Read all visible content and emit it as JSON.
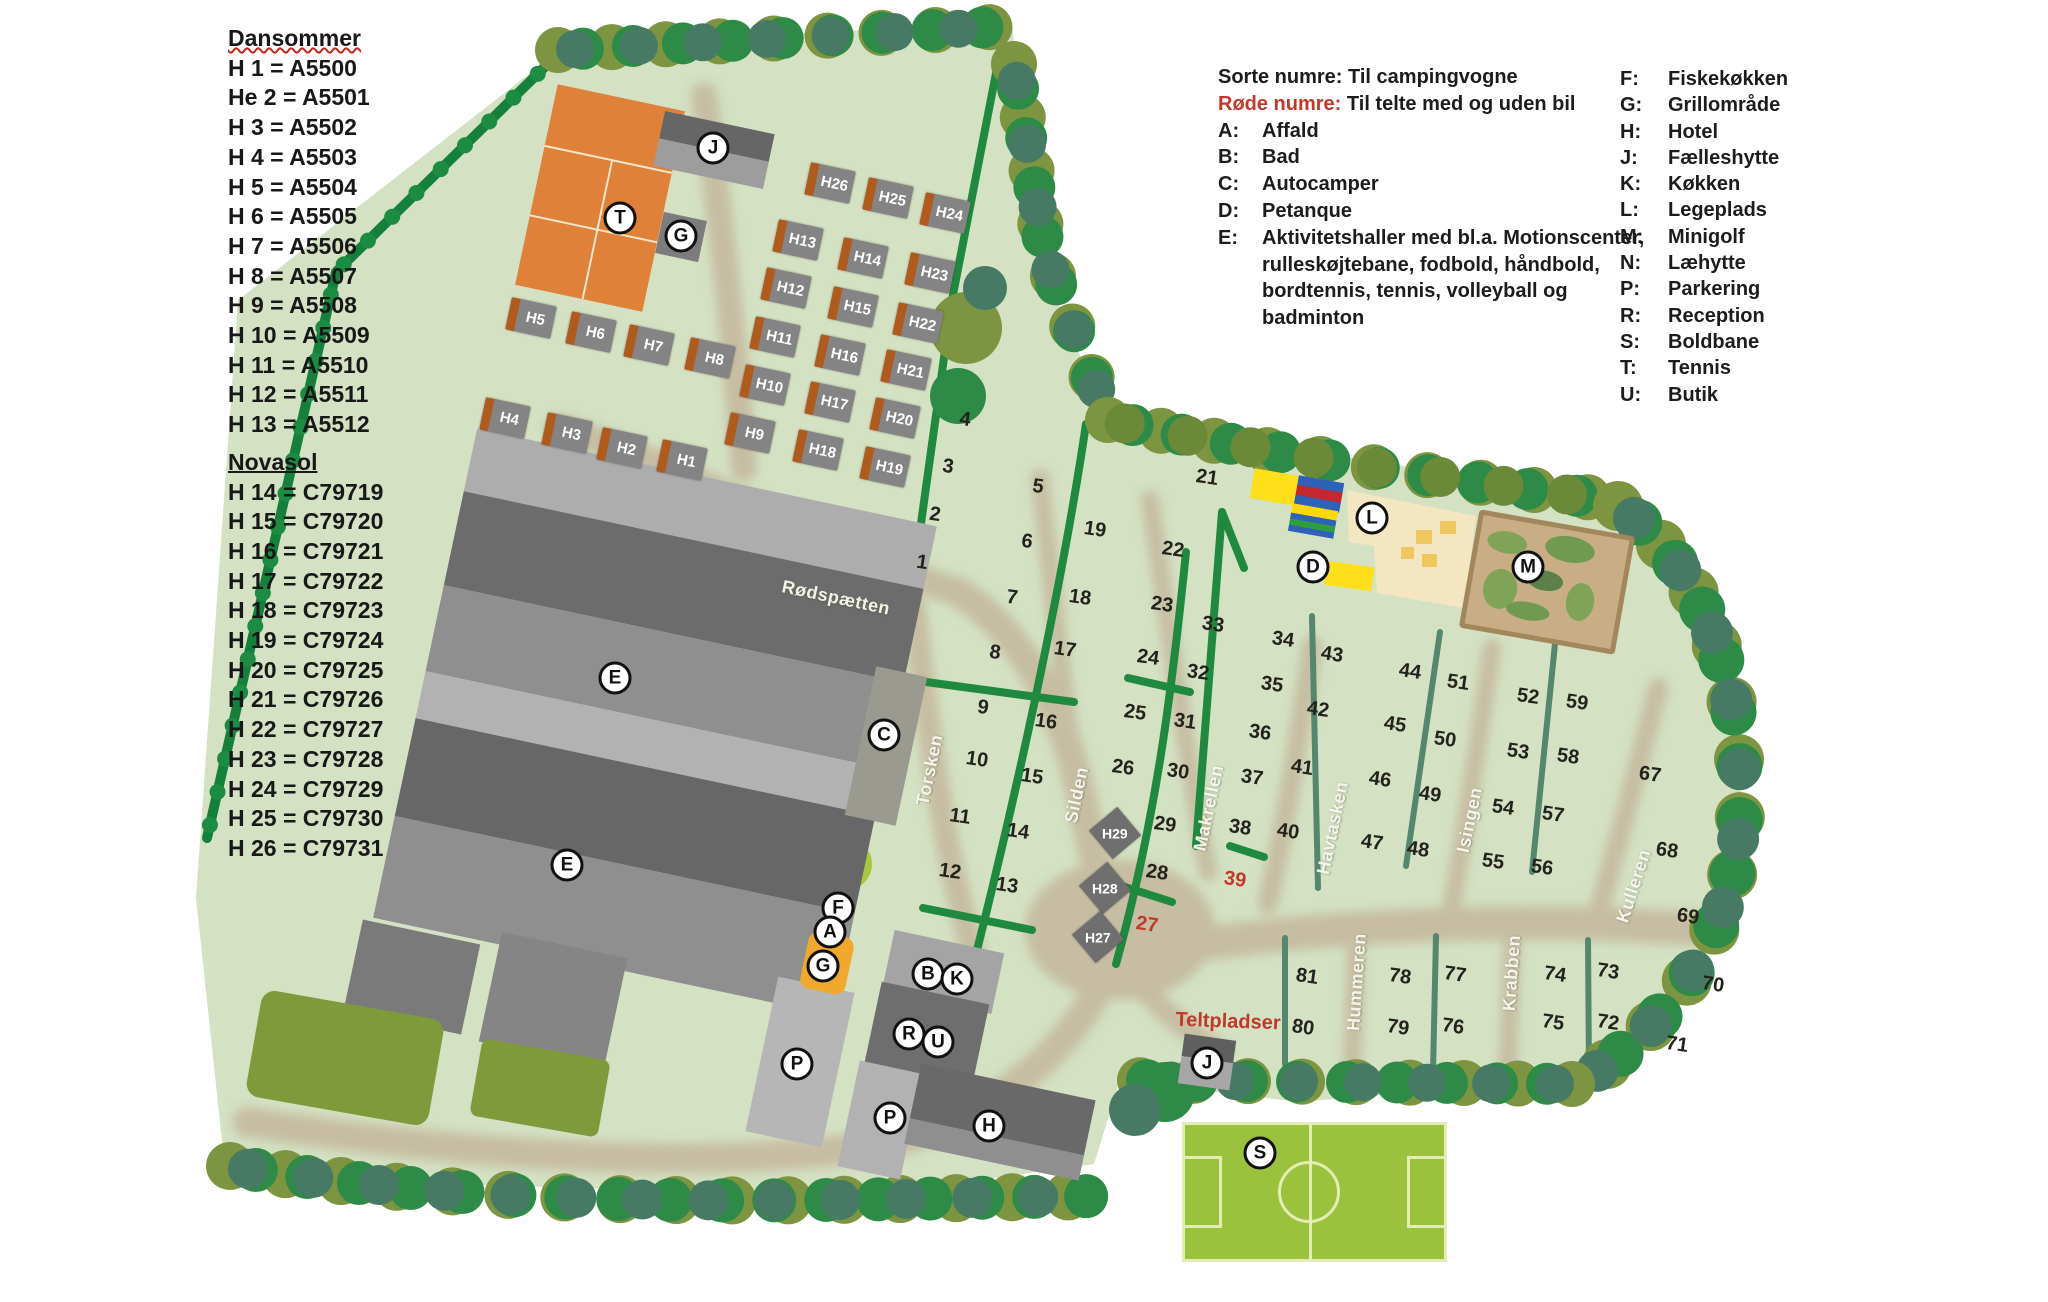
{
  "site_list": {
    "sections": [
      {
        "title": "Dansommer",
        "underline": "wavy",
        "items": [
          "H 1 = A5500",
          "He 2 = A5501",
          "H 3 = A5502",
          "H 4 = A5503",
          "H 5 = A5504",
          "H 6 = A5505",
          "H 7 = A5506",
          "H 8 = A5507",
          "H 9 = A5508",
          "H 10 = A5509",
          "H 11 = A5510",
          "H 12 = A5511",
          "H 13 = A5512"
        ]
      },
      {
        "title": "Novasol",
        "underline": "solid",
        "items": [
          "H 14 = C79719",
          "H 15 = C79720",
          "H 16 = C79721",
          "H 17 = C79722",
          "H 18 = C79723",
          "H 19 = C79724",
          "H 20 = C79725",
          "H 21 = C79726",
          "H 22 = C79727",
          "H 23 = C79728",
          "H 24 = C79729",
          "H 25 = C79730",
          "H 26 = C79731"
        ]
      }
    ]
  },
  "legend": {
    "note_black": "Sorte numre: Til campingvogne",
    "note_red_prefix": "Røde numre:",
    "note_red_rest": " Til telte med og uden bil",
    "left_items": [
      {
        "key": "A:",
        "label": "Affald",
        "extra": []
      },
      {
        "key": "B:",
        "label": "Bad",
        "extra": []
      },
      {
        "key": "C:",
        "label": "Autocamper",
        "extra": []
      },
      {
        "key": "D:",
        "label": "Petanque",
        "extra": []
      },
      {
        "key": "E:",
        "label": "Aktivitetshaller med bl.a. Motionscenter,",
        "extra": [
          "rulleskøjtebane, fodbold, håndbold,",
          "bordtennis, tennis, volleyball og",
          "badminton"
        ]
      }
    ],
    "right_items": [
      {
        "key": "F:",
        "label": "Fiskekøkken"
      },
      {
        "key": "G:",
        "label": "Grillområde"
      },
      {
        "key": "H:",
        "label": "Hotel"
      },
      {
        "key": "J:",
        "label": "Fælleshytte"
      },
      {
        "key": "K:",
        "label": "Køkken"
      },
      {
        "key": "L:",
        "label": "Legeplads"
      },
      {
        "key": "M:",
        "label": "Minigolf"
      },
      {
        "key": "N:",
        "label": "Læhytte"
      },
      {
        "key": "P:",
        "label": "Parkering"
      },
      {
        "key": "R:",
        "label": "Reception"
      },
      {
        "key": "S:",
        "label": "Boldbane"
      },
      {
        "key": "T:",
        "label": "Tennis"
      },
      {
        "key": "U:",
        "label": "Butik"
      }
    ]
  },
  "map": {
    "pitch_numbers_black": [
      {
        "n": "1",
        "x": 922,
        "y": 563
      },
      {
        "n": "2",
        "x": 935,
        "y": 515
      },
      {
        "n": "3",
        "x": 948,
        "y": 467
      },
      {
        "n": "4",
        "x": 965,
        "y": 420
      },
      {
        "n": "5",
        "x": 1038,
        "y": 487
      },
      {
        "n": "6",
        "x": 1027,
        "y": 542
      },
      {
        "n": "7",
        "x": 1012,
        "y": 598
      },
      {
        "n": "8",
        "x": 995,
        "y": 653
      },
      {
        "n": "9",
        "x": 983,
        "y": 708
      },
      {
        "n": "10",
        "x": 977,
        "y": 760
      },
      {
        "n": "11",
        "x": 960,
        "y": 817
      },
      {
        "n": "12",
        "x": 950,
        "y": 872
      },
      {
        "n": "13",
        "x": 1007,
        "y": 886
      },
      {
        "n": "14",
        "x": 1018,
        "y": 832
      },
      {
        "n": "15",
        "x": 1032,
        "y": 777
      },
      {
        "n": "16",
        "x": 1046,
        "y": 722
      },
      {
        "n": "17",
        "x": 1065,
        "y": 650
      },
      {
        "n": "18",
        "x": 1080,
        "y": 598
      },
      {
        "n": "19",
        "x": 1095,
        "y": 530
      },
      {
        "n": "21",
        "x": 1207,
        "y": 478
      },
      {
        "n": "22",
        "x": 1173,
        "y": 550
      },
      {
        "n": "23",
        "x": 1162,
        "y": 605
      },
      {
        "n": "24",
        "x": 1148,
        "y": 658
      },
      {
        "n": "25",
        "x": 1135,
        "y": 713
      },
      {
        "n": "26",
        "x": 1123,
        "y": 768
      },
      {
        "n": "28",
        "x": 1157,
        "y": 873
      },
      {
        "n": "29",
        "x": 1165,
        "y": 825
      },
      {
        "n": "30",
        "x": 1178,
        "y": 772
      },
      {
        "n": "31",
        "x": 1185,
        "y": 722
      },
      {
        "n": "32",
        "x": 1198,
        "y": 673
      },
      {
        "n": "33",
        "x": 1213,
        "y": 625
      },
      {
        "n": "34",
        "x": 1283,
        "y": 640
      },
      {
        "n": "35",
        "x": 1272,
        "y": 685
      },
      {
        "n": "36",
        "x": 1260,
        "y": 733
      },
      {
        "n": "37",
        "x": 1252,
        "y": 778
      },
      {
        "n": "38",
        "x": 1240,
        "y": 828
      },
      {
        "n": "40",
        "x": 1288,
        "y": 832
      },
      {
        "n": "41",
        "x": 1302,
        "y": 768
      },
      {
        "n": "42",
        "x": 1318,
        "y": 710
      },
      {
        "n": "43",
        "x": 1332,
        "y": 655
      },
      {
        "n": "44",
        "x": 1410,
        "y": 672
      },
      {
        "n": "45",
        "x": 1395,
        "y": 725
      },
      {
        "n": "46",
        "x": 1380,
        "y": 780
      },
      {
        "n": "47",
        "x": 1372,
        "y": 843
      },
      {
        "n": "48",
        "x": 1418,
        "y": 850
      },
      {
        "n": "49",
        "x": 1430,
        "y": 795
      },
      {
        "n": "50",
        "x": 1445,
        "y": 740
      },
      {
        "n": "51",
        "x": 1458,
        "y": 683
      },
      {
        "n": "52",
        "x": 1528,
        "y": 697
      },
      {
        "n": "53",
        "x": 1518,
        "y": 752
      },
      {
        "n": "54",
        "x": 1503,
        "y": 808
      },
      {
        "n": "55",
        "x": 1493,
        "y": 862
      },
      {
        "n": "56",
        "x": 1542,
        "y": 868
      },
      {
        "n": "57",
        "x": 1553,
        "y": 815
      },
      {
        "n": "58",
        "x": 1568,
        "y": 757
      },
      {
        "n": "59",
        "x": 1577,
        "y": 703
      },
      {
        "n": "67",
        "x": 1650,
        "y": 775
      },
      {
        "n": "68",
        "x": 1667,
        "y": 851
      },
      {
        "n": "69",
        "x": 1688,
        "y": 917
      },
      {
        "n": "70",
        "x": 1713,
        "y": 985
      },
      {
        "n": "71",
        "x": 1677,
        "y": 1045
      },
      {
        "n": "72",
        "x": 1608,
        "y": 1023
      },
      {
        "n": "73",
        "x": 1608,
        "y": 972
      },
      {
        "n": "74",
        "x": 1555,
        "y": 975
      },
      {
        "n": "75",
        "x": 1553,
        "y": 1023
      },
      {
        "n": "76",
        "x": 1453,
        "y": 1027
      },
      {
        "n": "77",
        "x": 1455,
        "y": 975
      },
      {
        "n": "78",
        "x": 1400,
        "y": 977
      },
      {
        "n": "79",
        "x": 1398,
        "y": 1028
      },
      {
        "n": "80",
        "x": 1303,
        "y": 1028
      },
      {
        "n": "81",
        "x": 1307,
        "y": 977
      }
    ],
    "pitch_numbers_red": [
      {
        "n": "27",
        "x": 1147,
        "y": 925
      },
      {
        "n": "39",
        "x": 1235,
        "y": 880
      }
    ],
    "cabins": [
      {
        "id": "H1",
        "x": 682,
        "y": 460
      },
      {
        "id": "H2",
        "x": 622,
        "y": 448
      },
      {
        "id": "H3",
        "x": 567,
        "y": 433
      },
      {
        "id": "H4",
        "x": 505,
        "y": 418
      },
      {
        "id": "H5",
        "x": 531,
        "y": 318
      },
      {
        "id": "H6",
        "x": 591,
        "y": 332
      },
      {
        "id": "H7",
        "x": 649,
        "y": 345
      },
      {
        "id": "H8",
        "x": 710,
        "y": 358
      },
      {
        "id": "H9",
        "x": 750,
        "y": 433
      },
      {
        "id": "H10",
        "x": 765,
        "y": 385
      },
      {
        "id": "H11",
        "x": 775,
        "y": 337
      },
      {
        "id": "H12",
        "x": 786,
        "y": 288
      },
      {
        "id": "H13",
        "x": 798,
        "y": 240
      },
      {
        "id": "H14",
        "x": 863,
        "y": 258
      },
      {
        "id": "H15",
        "x": 853,
        "y": 307
      },
      {
        "id": "H16",
        "x": 840,
        "y": 355
      },
      {
        "id": "H17",
        "x": 830,
        "y": 402
      },
      {
        "id": "H18",
        "x": 818,
        "y": 450
      },
      {
        "id": "H19",
        "x": 885,
        "y": 467
      },
      {
        "id": "H20",
        "x": 895,
        "y": 418
      },
      {
        "id": "H21",
        "x": 906,
        "y": 370
      },
      {
        "id": "H22",
        "x": 918,
        "y": 323
      },
      {
        "id": "H23",
        "x": 930,
        "y": 273
      },
      {
        "id": "H24",
        "x": 945,
        "y": 213
      },
      {
        "id": "H25",
        "x": 888,
        "y": 198
      },
      {
        "id": "H26",
        "x": 830,
        "y": 183
      }
    ],
    "cabin_diamonds": [
      {
        "id": "H29",
        "x": 1115,
        "y": 833
      },
      {
        "id": "H28",
        "x": 1105,
        "y": 888
      },
      {
        "id": "H27",
        "x": 1098,
        "y": 937
      }
    ],
    "markers": [
      {
        "letter": "J",
        "x": 713,
        "y": 148
      },
      {
        "letter": "T",
        "x": 620,
        "y": 218
      },
      {
        "letter": "G",
        "x": 681,
        "y": 236
      },
      {
        "letter": "E",
        "x": 615,
        "y": 678
      },
      {
        "letter": "E",
        "x": 567,
        "y": 865
      },
      {
        "letter": "C",
        "x": 884,
        "y": 735
      },
      {
        "letter": "F",
        "x": 838,
        "y": 908
      },
      {
        "letter": "A",
        "x": 830,
        "y": 932
      },
      {
        "letter": "G",
        "x": 823,
        "y": 966
      },
      {
        "letter": "B",
        "x": 928,
        "y": 974
      },
      {
        "letter": "K",
        "x": 957,
        "y": 979
      },
      {
        "letter": "R",
        "x": 909,
        "y": 1034
      },
      {
        "letter": "U",
        "x": 938,
        "y": 1042
      },
      {
        "letter": "P",
        "x": 797,
        "y": 1064
      },
      {
        "letter": "P",
        "x": 890,
        "y": 1118
      },
      {
        "letter": "H",
        "x": 989,
        "y": 1126
      },
      {
        "letter": "J",
        "x": 1207,
        "y": 1063
      },
      {
        "letter": "L",
        "x": 1372,
        "y": 518
      },
      {
        "letter": "D",
        "x": 1313,
        "y": 567
      },
      {
        "letter": "M",
        "x": 1528,
        "y": 567
      },
      {
        "letter": "S",
        "x": 1260,
        "y": 1153
      }
    ],
    "road_labels": [
      {
        "name": "Rødspætten",
        "x": 836,
        "y": 598,
        "rot": 12
      },
      {
        "name": "Torsken",
        "x": 930,
        "y": 770,
        "rot": -78
      },
      {
        "name": "Silden",
        "x": 1077,
        "y": 795,
        "rot": -78
      },
      {
        "name": "Makrellen",
        "x": 1209,
        "y": 808,
        "rot": -78
      },
      {
        "name": "Havtasken",
        "x": 1333,
        "y": 828,
        "rot": -78
      },
      {
        "name": "Isingen",
        "x": 1470,
        "y": 820,
        "rot": -78
      },
      {
        "name": "Kulleren",
        "x": 1634,
        "y": 886,
        "rot": -72
      },
      {
        "name": "Hummeren",
        "x": 1357,
        "y": 982,
        "rot": -86
      },
      {
        "name": "Krabben",
        "x": 1512,
        "y": 973,
        "rot": -86
      }
    ],
    "area_label_red": {
      "text": "Teltpladser",
      "x": 1228,
      "y": 1022
    }
  },
  "colors": {
    "land": "#d4e1c3",
    "tree_dark": "#2e8b47",
    "tree_olive": "#7d9440",
    "tree_teal": "#477a65",
    "hedge": "#1f8a3f",
    "hedge_teal": "#55876c",
    "road": "#c3b59a",
    "building_dark": "#6c6c6c",
    "building_light": "#adadad",
    "cabin_gray": "#848484",
    "cabin_orange": "#b05a1e",
    "tennis_orange": "#e0813a",
    "field_green": "#9ac23d",
    "minigolf_tan": "#c9ad85",
    "playground_cream": "#f4e6c1",
    "red_text": "#bf3a2a",
    "marker_bg": "#ffffff"
  }
}
